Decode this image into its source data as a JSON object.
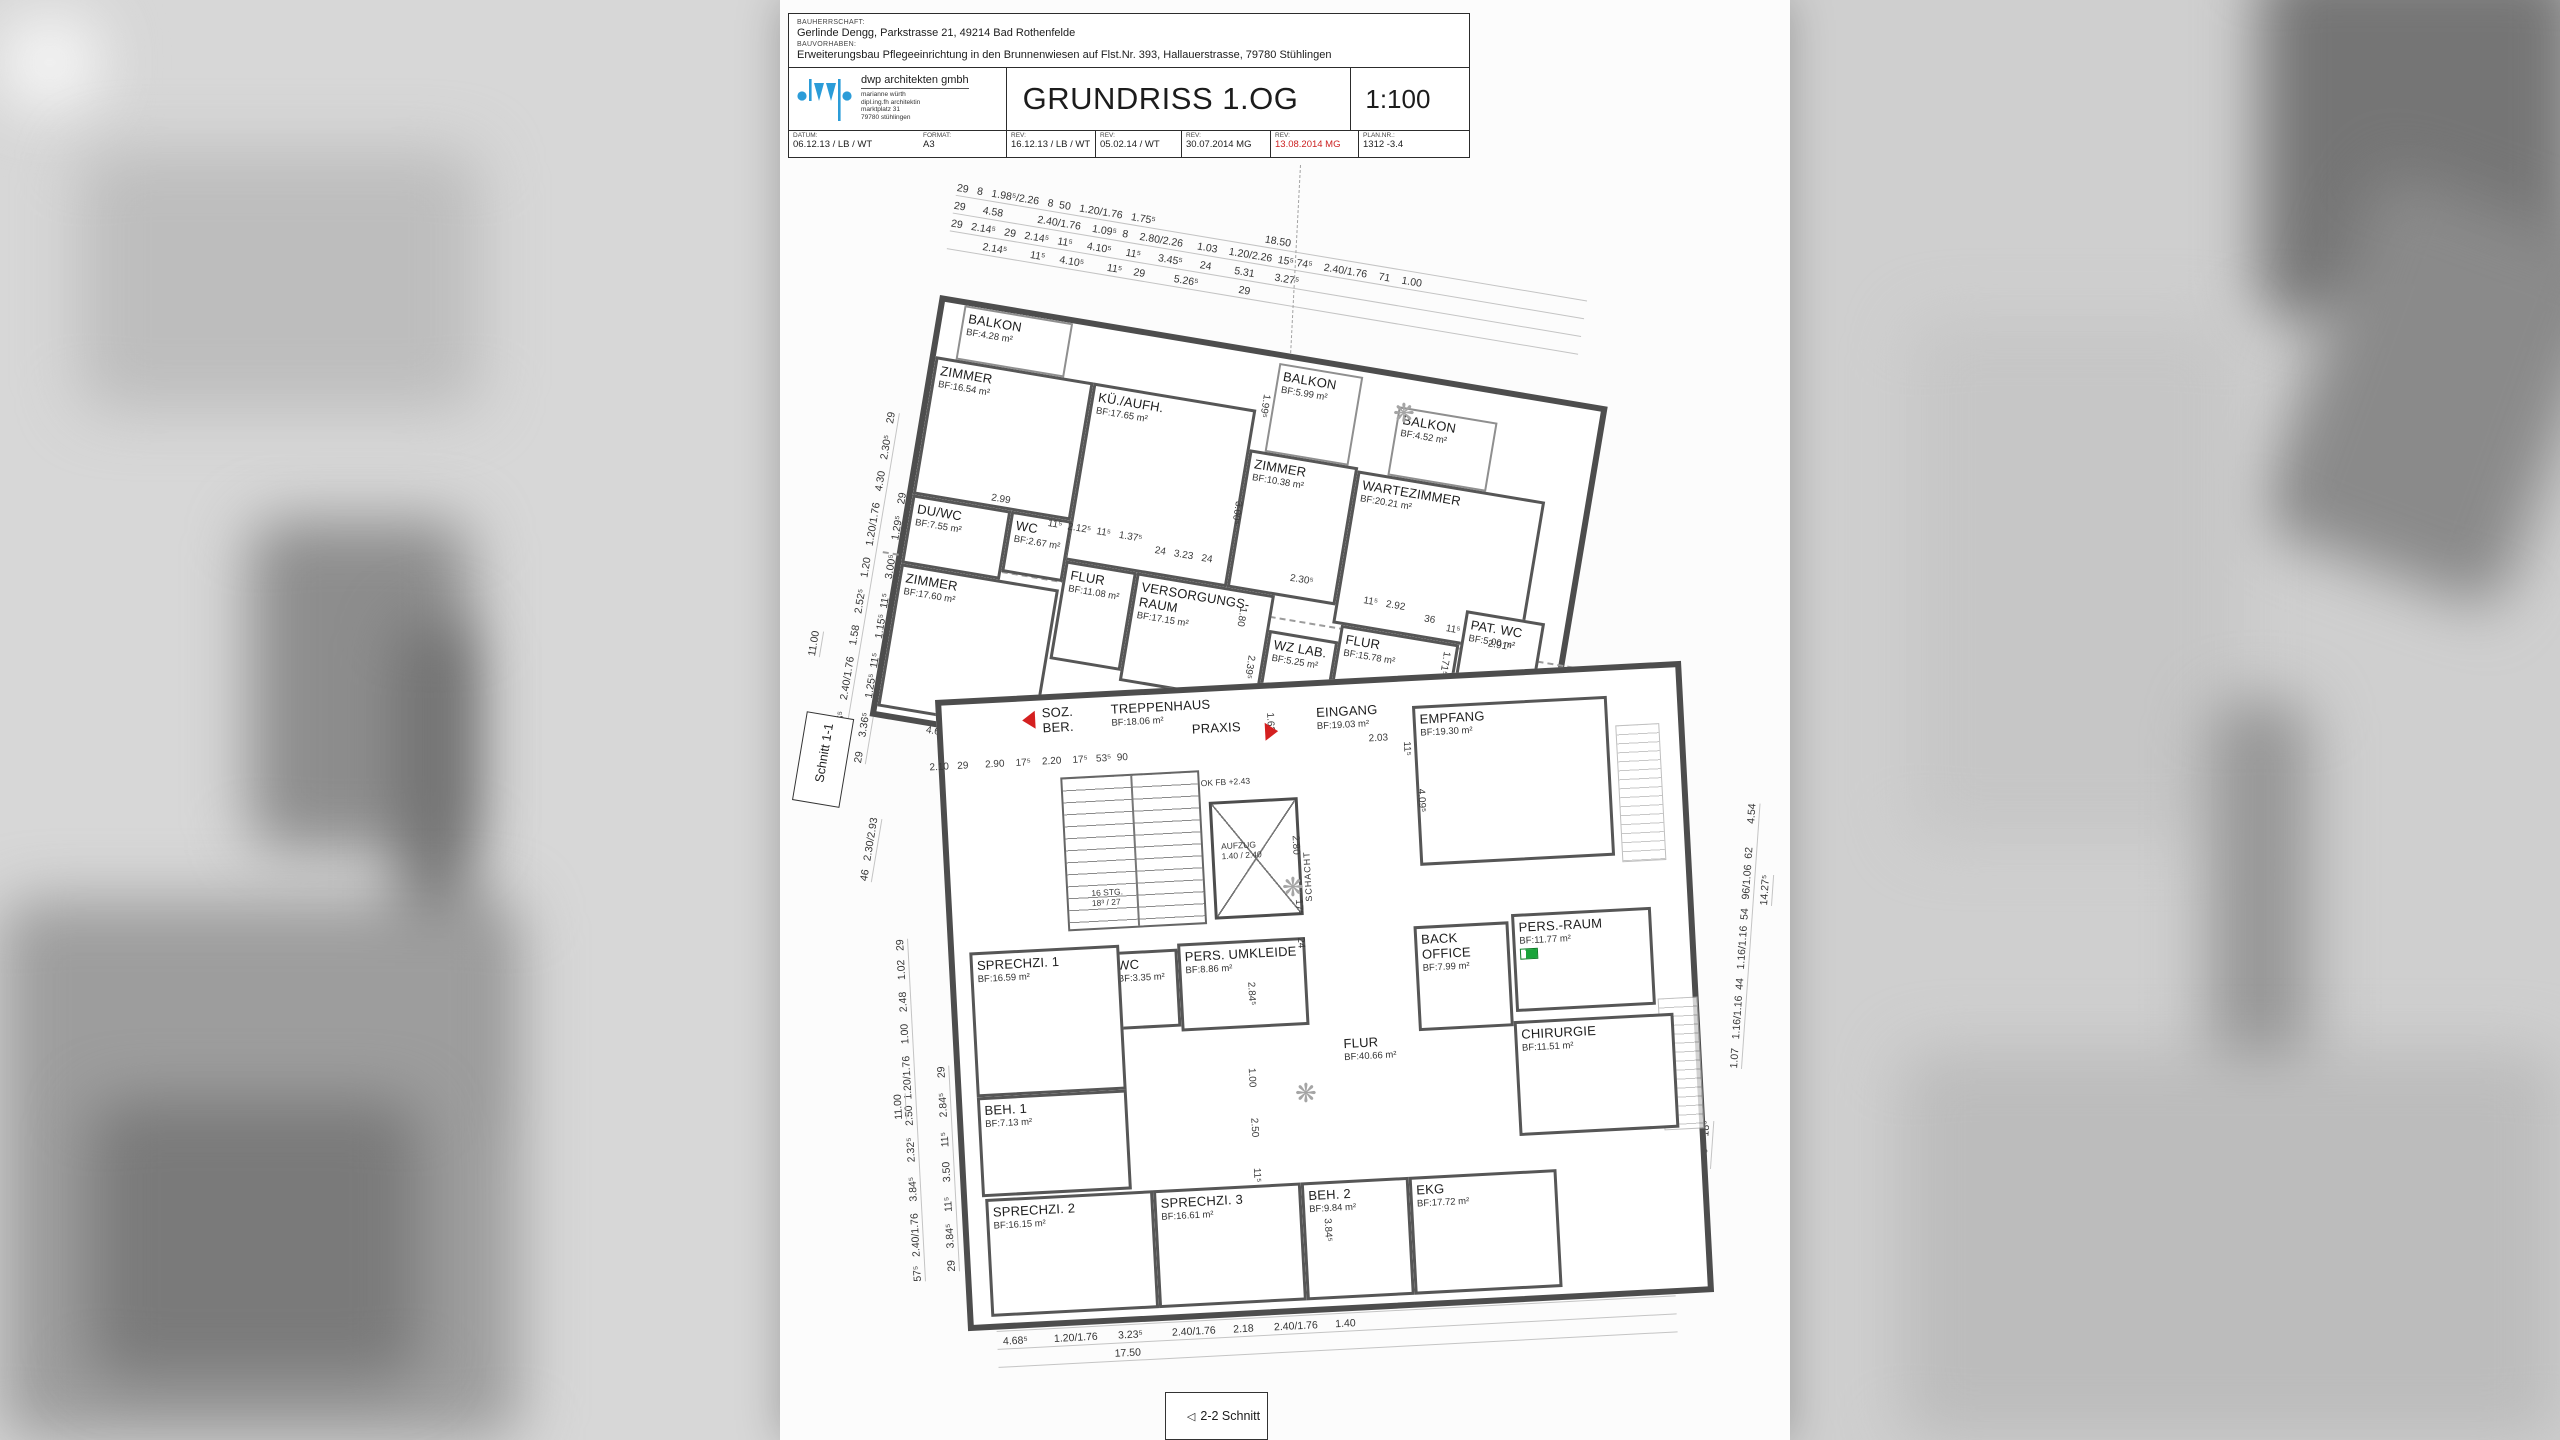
{
  "colors": {
    "wall": "#4d4d4d",
    "accent_red": "#d42020",
    "exit_green": "#19a43a",
    "logo_blue": "#2b9cd8"
  },
  "titleblock": {
    "bauherrschaft_label": "BAUHERRSCHAFT:",
    "bauherrschaft": "Gerlinde Dengg, Parkstrasse 21, 49214 Bad Rothenfelde",
    "bauvorhaben_label": "BAUVORHABEN:",
    "bauvorhaben": "Erweiterungsbau Pflegeeinrichtung in den Brunnenwiesen auf Flst.Nr. 393, Hallauerstrasse, 79780 Stühlingen",
    "firm": "dwp architekten gmbh",
    "architect_lines": [
      "marianne würth",
      "dipl.ing.fh architektin",
      "marktplatz 31",
      "79780 stühlingen"
    ],
    "title": "GRUNDRISS 1.OG",
    "scale": "1:100",
    "meta": [
      {
        "label": "DATUM:",
        "value": "06.12.13 / LB / WT",
        "w": 130,
        "first": true
      },
      {
        "label": "FORMAT:",
        "value": "A3",
        "w": 87,
        "nb": true
      },
      {
        "label": "REV:",
        "value": "16.12.13 / LB / WT",
        "w": 89
      },
      {
        "label": "REV:",
        "value": "05.02.14 / WT",
        "w": 86
      },
      {
        "label": "REV:",
        "value": "30.07.2014 MG",
        "w": 89
      },
      {
        "label": "REV:",
        "value": "13.08.2014 MG",
        "w": 88,
        "color": "#cc2020"
      },
      {
        "label": "PLAN.NR.:",
        "value": "1312 -3.4",
        "w": 111
      }
    ]
  },
  "plan": {
    "wings": [
      {
        "id": "upper-wing",
        "rooms": [
          {
            "name": "BALKON",
            "area": "BF:4.28 m²",
            "x": 20,
            "y": 0,
            "w": 110,
            "h": 55,
            "type": "balcony"
          },
          {
            "name": "ZIMMER",
            "area": "BF:16.54 m²",
            "x": 0,
            "y": 55,
            "w": 160,
            "h": 140
          },
          {
            "name": "KÜ./AUFH.",
            "area": "BF:17.65 m²",
            "x": 160,
            "y": 55,
            "w": 165,
            "h": 180
          },
          {
            "name": "BALKON",
            "area": "BF:5.99 m²",
            "x": 340,
            "y": 5,
            "w": 85,
            "h": 90,
            "type": "balcony"
          },
          {
            "name": "ZIMMER",
            "area": "BF:10.38 m²",
            "x": 325,
            "y": 95,
            "w": 110,
            "h": 140
          },
          {
            "name": "BALKON",
            "area": "BF:4.52 m²",
            "x": 465,
            "y": 28,
            "w": 100,
            "h": 70,
            "type": "balcony"
          },
          {
            "name": "WARTEZIMMER",
            "area": "BF:20.21 m²",
            "x": 435,
            "y": 98,
            "w": 190,
            "h": 155
          },
          {
            "name": "DU/WC",
            "area": "BF:7.55 m²",
            "x": 0,
            "y": 195,
            "w": 100,
            "h": 70
          },
          {
            "name": "WC",
            "area": "BF:2.67 m²",
            "x": 100,
            "y": 195,
            "w": 62,
            "h": 62
          },
          {
            "name": "FLUR",
            "area": "BF:11.08 m²",
            "x": 162,
            "y": 235,
            "w": 72,
            "h": 100
          },
          {
            "name": "ZIMMER",
            "area": "BF:17.60 m²",
            "x": 0,
            "y": 265,
            "w": 160,
            "h": 145
          },
          {
            "name": "VERSORGUNGS-RAUM",
            "area": "BF:17.15 m²",
            "x": 234,
            "y": 235,
            "w": 140,
            "h": 110
          },
          {
            "name": "WZ LAB.",
            "area": "BF:5.25 m²",
            "x": 374,
            "y": 270,
            "w": 70,
            "h": 80
          },
          {
            "name": "FLUR",
            "area": "BF:15.78 m²",
            "x": 444,
            "y": 253,
            "w": 120,
            "h": 112
          },
          {
            "name": "PAT. WC",
            "area": "BF:5.00 m²",
            "x": 565,
            "y": 218,
            "w": 80,
            "h": 68
          },
          {
            "name": "LABOR",
            "area": "BF:11.91 m²",
            "x": 565,
            "y": 286,
            "w": 80,
            "h": 100
          }
        ],
        "dims": [
          {
            "t": "2.99",
            "x": 78,
            "y": 180
          },
          {
            "t": "11⁵  2.12⁵  11⁵   1.37⁵",
            "x": 138,
            "y": 196
          },
          {
            "t": "24   3.23   24",
            "x": 248,
            "y": 205
          },
          {
            "t": "2.30⁵",
            "x": 386,
            "y": 210
          },
          {
            "t": "11⁵   2.92",
            "x": 462,
            "y": 220
          },
          {
            "t": "36",
            "x": 525,
            "y": 228
          },
          {
            "t": "11⁵",
            "x": 548,
            "y": 234
          },
          {
            "t": "2.91⁵",
            "x": 592,
            "y": 242
          },
          {
            "t": "1.80",
            "x": 350,
            "y": 252,
            "r": 90
          },
          {
            "t": "1.71⁵",
            "x": 558,
            "y": 262,
            "r": 90
          },
          {
            "t": "2.39⁵",
            "x": 366,
            "y": 298,
            "r": 90
          },
          {
            "t": "3.63⁵",
            "x": 540,
            "y": 330,
            "r": 90
          },
          {
            "t": "3.00⁵",
            "x": 328,
            "y": 148,
            "r": 90
          },
          {
            "t": "1.99⁵",
            "x": 338,
            "y": 38,
            "r": 90
          },
          {
            "t": "4.69",
            "x": 52,
            "y": 420
          }
        ],
        "markers": []
      },
      {
        "id": "lower-wing",
        "rooms": [
          {
            "name": "SOZ.\nBER.",
            "x": 96,
            "y": 2,
            "w": 55,
            "h": 40,
            "type": "label"
          },
          {
            "name": "PRAXIS",
            "x": 245,
            "y": 26,
            "w": 80,
            "h": 24,
            "type": "label"
          },
          {
            "name": "TREPPENHAUS",
            "area": "BF:18.06 m²",
            "x": 165,
            "y": 2,
            "w": 130,
            "h": 40,
            "type": "label"
          },
          {
            "name": "EINGANG",
            "area": "BF:19.03 m²",
            "x": 370,
            "y": 16,
            "w": 110,
            "h": 40,
            "type": "label"
          },
          {
            "name": "EMPFANG",
            "area": "BF:19.30 m²",
            "x": 470,
            "y": 25,
            "w": 195,
            "h": 160
          },
          {
            "name": "WC",
            "area": "BF:3.35 m²",
            "x": 155,
            "y": 255,
            "w": 68,
            "h": 78
          },
          {
            "name": "PERS. UMKLEIDE",
            "area": "BF:8.86 m²",
            "x": 223,
            "y": 250,
            "w": 128,
            "h": 88
          },
          {
            "name": "BACK OFFICE",
            "area": "BF:7.99 m²",
            "x": 460,
            "y": 245,
            "w": 95,
            "h": 105
          },
          {
            "name": "PERS.-RAUM",
            "area": "BF:11.77 m²",
            "x": 558,
            "y": 238,
            "w": 140,
            "h": 98,
            "icon": "exit"
          },
          {
            "name": "SPRECHZI. 1",
            "area": "BF:16.59 m²",
            "x": 15,
            "y": 248,
            "w": 150,
            "h": 145
          },
          {
            "name": "BEH. 1",
            "area": "BF:7.13 m²",
            "x": 15,
            "y": 393,
            "w": 150,
            "h": 100
          },
          {
            "name": "FLUR",
            "area": "BF:40.66 m²",
            "x": 380,
            "y": 348,
            "w": 90,
            "h": 40,
            "type": "label"
          },
          {
            "name": "CHIRURGIE",
            "area": "BF:11.51 m²",
            "x": 555,
            "y": 345,
            "w": 160,
            "h": 115
          },
          {
            "name": "SPRECHZI. 2",
            "area": "BF:16.15 m²",
            "x": 18,
            "y": 495,
            "w": 168,
            "h": 118
          },
          {
            "name": "SPRECHZI. 3",
            "area": "BF:16.61 m²",
            "x": 186,
            "y": 495,
            "w": 148,
            "h": 118
          },
          {
            "name": "BEH. 2",
            "area": "BF:9.84 m²",
            "x": 334,
            "y": 495,
            "w": 108,
            "h": 118
          },
          {
            "name": "EKG",
            "area": "BF:17.72 m²",
            "x": 442,
            "y": 495,
            "w": 148,
            "h": 118
          }
        ],
        "dims": [
          {
            "t": "2.10   29      2.90    17⁵    2.20    17⁵   53⁵  90",
            "x": -15,
            "y": 56
          },
          {
            "t": "2.03",
            "x": 425,
            "y": 50
          },
          {
            "t": "OK FB +2.43",
            "x": 255,
            "y": 86,
            "small": true
          },
          {
            "t": "16 STG.\n18³ / 27",
            "x": 140,
            "y": 190,
            "small": true
          },
          {
            "t": "1.62",
            "x": 333,
            "y": 24,
            "r": 90
          },
          {
            "t": "2.80",
            "x": 352,
            "y": 148,
            "r": 90
          },
          {
            "t": "17⁵",
            "x": 352,
            "y": 212,
            "r": 90
          },
          {
            "t": "24",
            "x": 352,
            "y": 250,
            "r": 90
          },
          {
            "t": "11⁵",
            "x": 468,
            "y": 60,
            "r": 90
          },
          {
            "t": "4.09⁵",
            "x": 480,
            "y": 108,
            "r": 90
          },
          {
            "t": "1.00",
            "x": 296,
            "y": 378,
            "r": 90
          },
          {
            "t": "2.50",
            "x": 296,
            "y": 428,
            "r": 90
          },
          {
            "t": "11⁵",
            "x": 296,
            "y": 478,
            "r": 90
          },
          {
            "t": "3.84⁵",
            "x": 364,
            "y": 532,
            "r": 90
          },
          {
            "t": "2.84⁵",
            "x": 300,
            "y": 292,
            "r": 90
          }
        ],
        "markers": [
          {
            "type": "tri-left",
            "x": 80,
            "y": 10
          },
          {
            "type": "tri-right",
            "x": 322,
            "y": 34
          }
        ]
      }
    ],
    "core": {
      "aufzug": "AUFZUG\n1.40 / 2.40",
      "schacht": "SCHACHT"
    },
    "edge_dims": {
      "top": [
        "29   8   1.98⁵/2.26   8  50   1.20/1.76   1.75⁵                                      18.50",
        "29      4.58            2.40/1.76    1.09⁵  8    2.80/2.26     1.03    1.20/2.26  15⁵ 74⁵    2.40/1.76    71    1.00",
        "29   2.14⁵   29   2.14⁵   11⁵     4.10⁵     11⁵      3.45⁵      24        5.31       3.27⁵",
        "            2.14⁵        11⁵     4.10⁵        11⁵    29          5.26⁵              29"
      ],
      "bottom": [
        "29  2.85   11⁵                          10.55                           11⁵   3.29   29",
        "29   4.20    11⁵         4.32         11⁵    2.56    11⁵          5.49⁵          29",
        "  4.68⁵         1.20/1.76       3.23⁵          2.40/1.76      2.18       2.40/1.76      1.40",
        "                                        17.50"
      ],
      "cols": [
        {
          "t": "11.00",
          "x": 806,
          "y": 655,
          "r": -80.5
        },
        {
          "t": "1.11⁵    3.36⁵    2.40/1.76    1.58    2.52⁵    1.20    1.20/1.76    4.30    2.30⁵    29",
          "x": 826,
          "y": 770,
          "r": -80.5
        },
        {
          "t": "29     3.36⁵     1.25⁵  11⁵     1.15⁵  11⁵     3.00⁵     1.29⁵    29",
          "x": 852,
          "y": 762,
          "r": -80.5
        },
        {
          "t": "46   2.30/2.93",
          "x": 858,
          "y": 880,
          "r": -80.5
        },
        {
          "t": "57⁵   2.40/1.76    3.84⁵     2.32⁵    2.50  1.20/1.76    1.00    2.48    1.02   29",
          "x": 912,
          "y": 1282,
          "r": -93
        },
        {
          "t": "29    3.84⁵    11⁵     3.50     11⁵     2.84⁵     29",
          "x": 946,
          "y": 1272,
          "r": -93
        },
        {
          "t": "11.00",
          "x": 893,
          "y": 1120,
          "r": -93
        },
        {
          "t": "14.27⁵",
          "x": 1758,
          "y": 905,
          "r": -86
        },
        {
          "t": "1.07   1.16/1.16  44   1.16/1.16  54   96/1.06  62        4.54",
          "x": 1728,
          "y": 1068,
          "r": -86
        },
        {
          "t": "3.60    18⁵",
          "x": 1697,
          "y": 1168,
          "r": -86
        }
      ]
    },
    "section_tags": {
      "schnitt11": "Schnitt 1-1",
      "schnitt22": "2-2 Schnitt"
    }
  }
}
